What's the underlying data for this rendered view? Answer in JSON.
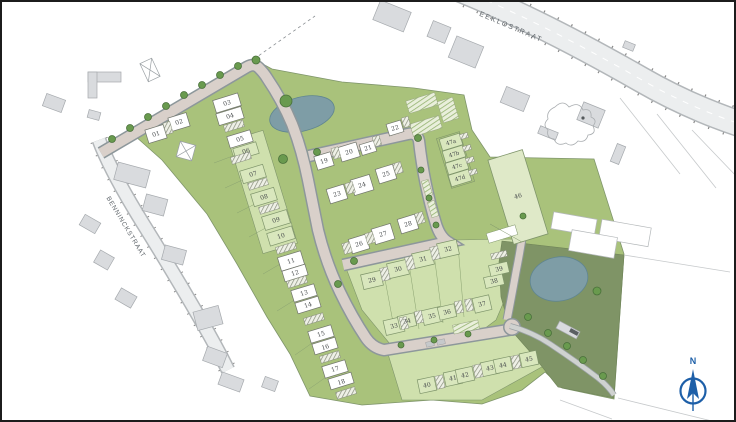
{
  "streets": {
    "eeklostraat": "EEKLOSTRAAT",
    "benninckstraat": "BENNINCKSTRAAT"
  },
  "compass": {
    "north_label": "N"
  },
  "lots": {
    "01": "01",
    "02": "02",
    "03": "03",
    "04": "04",
    "05": "05",
    "06": "06",
    "07": "07",
    "08": "08",
    "09": "09",
    "10": "10",
    "11": "11",
    "12": "12",
    "13": "13",
    "14": "14",
    "15": "15",
    "16": "16",
    "17": "17",
    "18": "18",
    "19": "19",
    "20": "20",
    "21": "21",
    "22": "22",
    "23": "23",
    "24": "24",
    "25": "25",
    "26": "26",
    "27": "27",
    "28": "28",
    "29": "29",
    "30": "30",
    "31": "31",
    "32": "32",
    "33": "33",
    "34": "34",
    "35": "35",
    "36": "36",
    "37": "37",
    "38": "38",
    "39": "39",
    "40": "40",
    "41": "41",
    "42": "42",
    "43": "43",
    "44": "44",
    "45": "45",
    "46": "46",
    "47a": "47a",
    "47b": "47b",
    "47c": "47c",
    "47d": "47d"
  },
  "colors": {
    "green_main": "#a9c27b",
    "green_light": "#cfe0ad",
    "green_lot": "#d9e7bd",
    "green_dark": "#7f9466",
    "water": "#7e9da6",
    "road_new": "#d9d0ca",
    "road_existing": "#eceeef",
    "building_gray": "#d9dbde",
    "compass_blue": "#1d5fa8"
  }
}
